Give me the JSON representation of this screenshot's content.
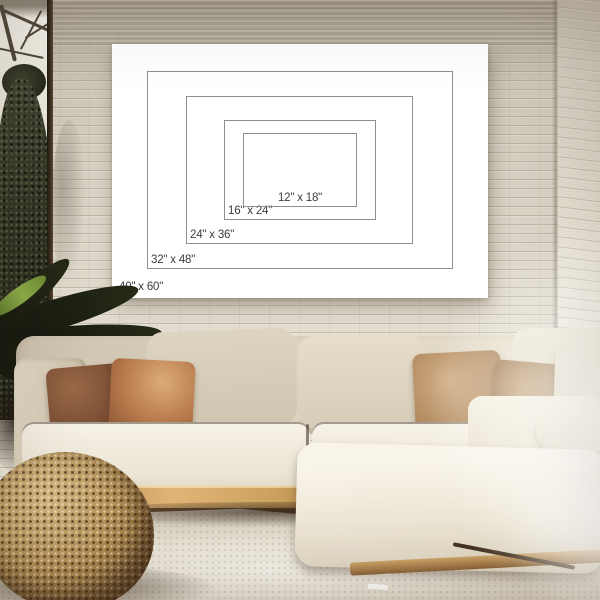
{
  "poster": {
    "sizes": [
      {
        "label": "12\" x 18\"",
        "width_in": 12,
        "height_in": 18
      },
      {
        "label": "16\" x 24\"",
        "width_in": 16,
        "height_in": 24
      },
      {
        "label": "24\" x 36\"",
        "width_in": 24,
        "height_in": 36
      },
      {
        "label": "32\" x 48\"",
        "width_in": 32,
        "height_in": 48
      },
      {
        "label": "40\" x 60\"",
        "width_in": 40,
        "height_in": 60
      }
    ],
    "colors": {
      "canvas": "#ffffff",
      "outline": "#8f8f8f",
      "text": "#3c3c3c"
    }
  },
  "scene": {
    "colors": {
      "wall": "#d8d2c6",
      "wall_shade_top": "#a69d8f",
      "sofa_seat": "#f4efe4",
      "sofa_back": "#d6ccb9",
      "pillow_dark_brown": "#7a4c33",
      "pillow_caramel": "#b5784a",
      "pillow_tan": "#b28a5e",
      "pillow_cream": "#ece4d3",
      "wood_base": "#cda361",
      "floor": "#54402d",
      "rug": "#d6cfc0",
      "pouf": "#ab874f",
      "foliage": "#23261a",
      "bright_leaf": "#8fae4a"
    }
  }
}
